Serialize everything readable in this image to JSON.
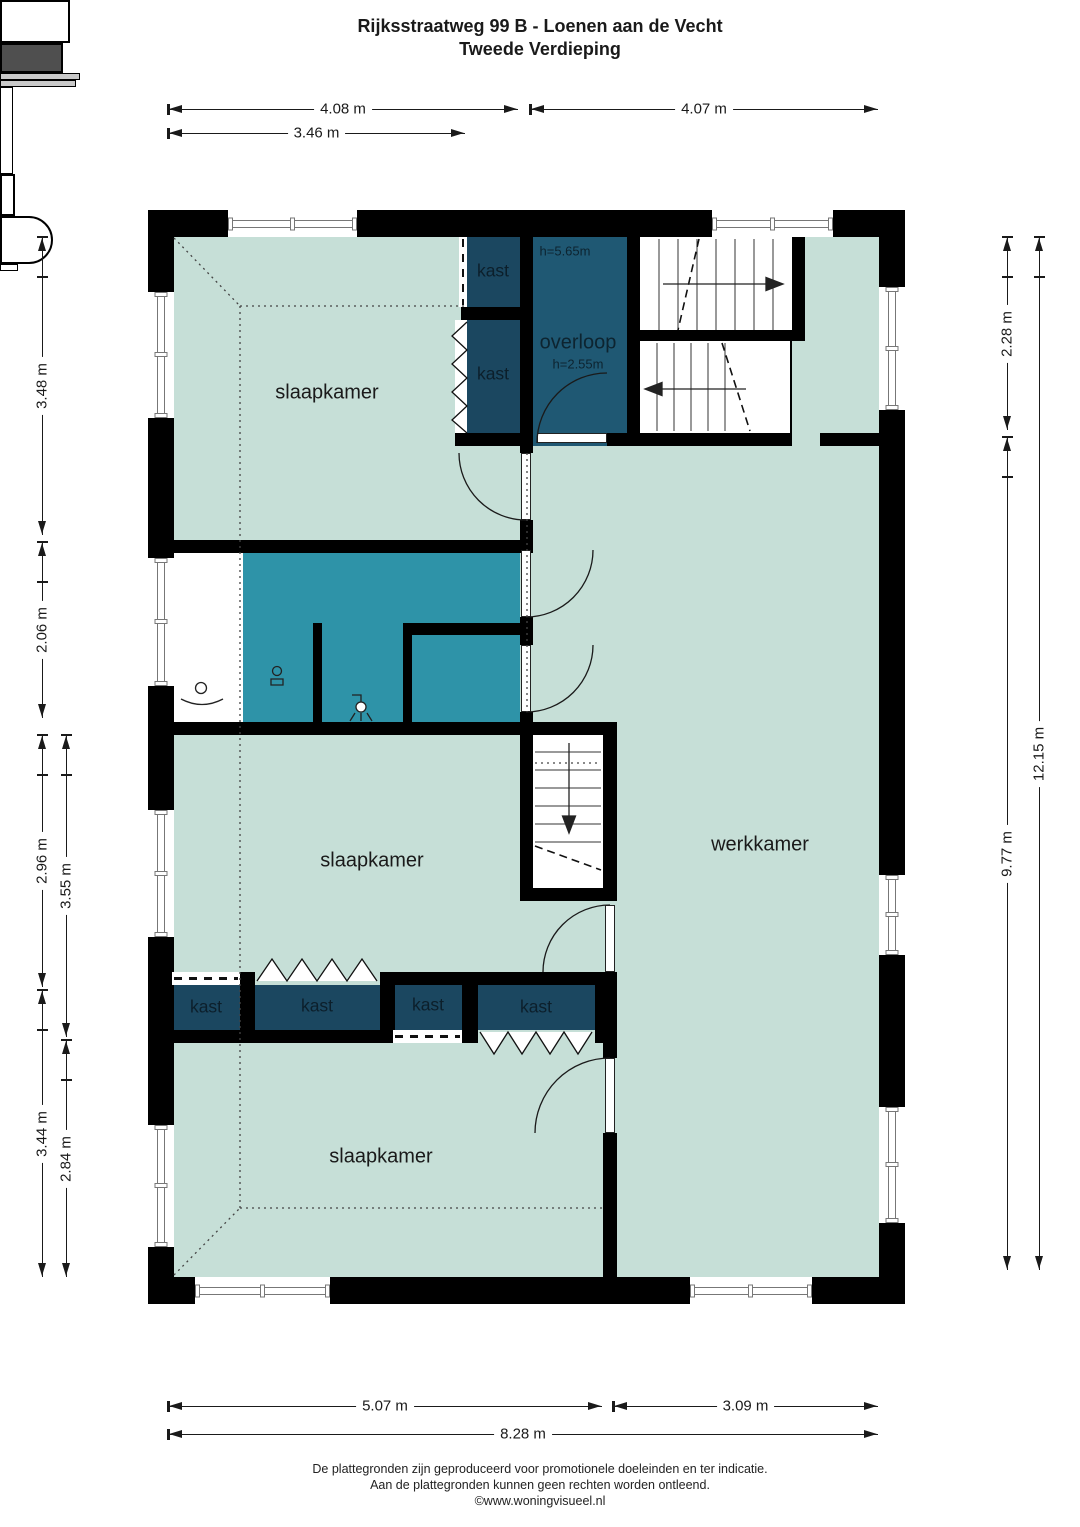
{
  "title": "Rijksstraatweg 99 B - Loenen aan de Vecht",
  "subtitle": "Tweede Verdieping",
  "rooms": {
    "slaapkamer_topleft": "slaapkamer",
    "slaapkamer_middle": "slaapkamer",
    "slaapkamer_bottom": "slaapkamer",
    "werkkamer": "werkkamer",
    "overloop": "overloop",
    "overloop_ceiling_height": "h=5.65m",
    "overloop_height": "h=2.55m"
  },
  "closets": [
    "kast",
    "kast",
    "kast",
    "kast",
    "kast",
    "kast"
  ],
  "dimensions": {
    "top": [
      "4.08 m",
      "4.07 m",
      "3.46 m"
    ],
    "left": [
      "3.48 m",
      "2.06 m",
      "2.96 m",
      "3.44 m",
      "3.55 m",
      "2.84 m"
    ],
    "right": [
      "2.28 m",
      "9.77 m",
      "12.15 m"
    ],
    "bottom": [
      "5.07 m",
      "3.09 m",
      "8.28 m"
    ]
  },
  "footer": [
    "De plattegronden zijn geproduceerd voor promotionele doeleinden en ter indicatie.",
    "Aan de plattegronden kunnen geen rechten worden ontleend.",
    "©www.woningvisueel.nl"
  ],
  "colors": {
    "floor": "#c6dfd7",
    "wet_room": "#2e93a8",
    "closet": "#1b4760",
    "hall": "#1f5873",
    "wall": "#000000",
    "appliance": "#4f4f4f"
  }
}
